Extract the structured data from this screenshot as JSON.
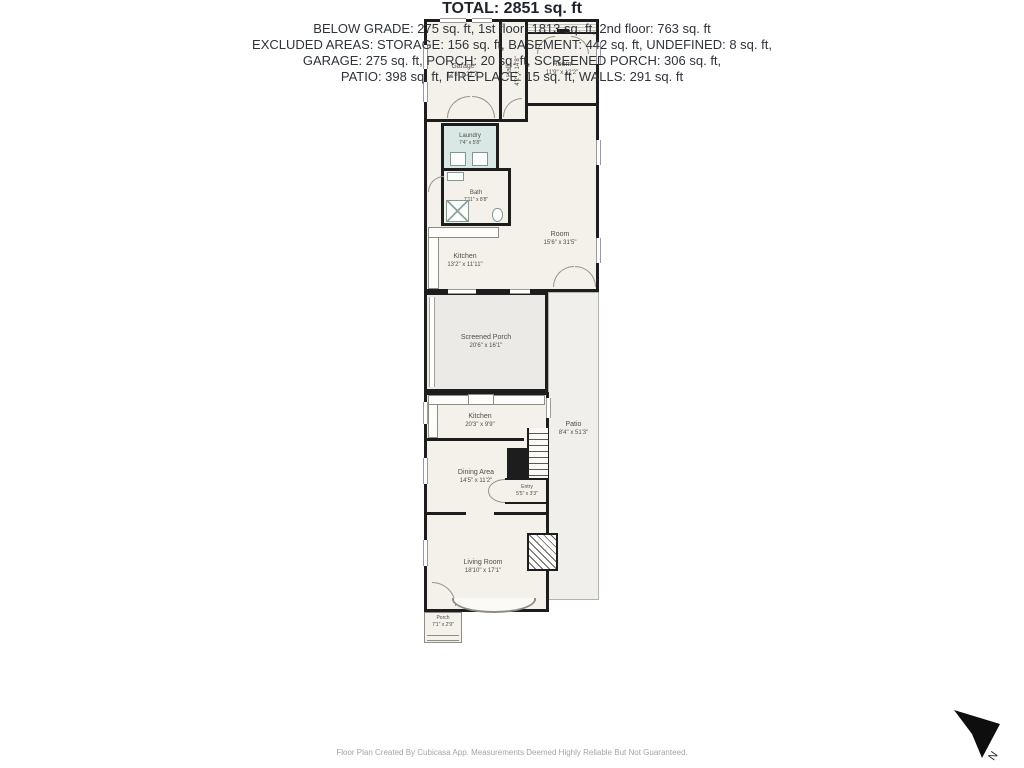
{
  "plan": {
    "rooms": {
      "garage": {
        "label": "Garage",
        "dims": "12'8\" x 27'7\""
      },
      "hall": {
        "label": "Hall",
        "dims": "4'2\" x 14'8\""
      },
      "top_room": {
        "label": "Room",
        "dims": "11'9\" x 12'2\""
      },
      "laundry": {
        "label": "Laundry",
        "dims": "7'4\" x 5'8\""
      },
      "bath": {
        "label": "Bath",
        "dims": "7'11\" x 8'8\""
      },
      "kitchen_upper": {
        "label": "Kitchen",
        "dims": "13'2\" x 11'11\""
      },
      "big_room": {
        "label": "Room",
        "dims": "15'6\" x 31'5\""
      },
      "screened_porch": {
        "label": "Screened Porch",
        "dims": "20'6\" x 16'1\""
      },
      "patio": {
        "label": "Patio",
        "dims": "8'4\" x 51'3\""
      },
      "kitchen_lower": {
        "label": "Kitchen",
        "dims": "20'3\" x 9'9\""
      },
      "dining": {
        "label": "Dining Area",
        "dims": "14'5\" x 11'2\""
      },
      "entry": {
        "label": "Entry",
        "dims": "5'5\" x 3'3\""
      },
      "living": {
        "label": "Living Room",
        "dims": "18'10\" x 17'1\""
      },
      "porch": {
        "label": "Porch",
        "dims": "7'1\" x 2'9\""
      }
    },
    "colors": {
      "wall": "#1d1d1d",
      "floor": "#f4f1ea",
      "laundry_fill": "#d9e8e4",
      "screened_porch_fill": "#eceae6",
      "patio_fill": "#f0efeb"
    }
  },
  "summary": {
    "total": "TOTAL: 2851 sq. ft",
    "lines": [
      "BELOW GRADE: 275 sq. ft, 1st floor: 1813 sq. ft, 2nd floor: 763 sq. ft",
      "EXCLUDED AREAS: STORAGE: 156 sq. ft, BASEMENT: 442 sq. ft, UNDEFINED: 8 sq. ft,",
      "GARAGE: 275 sq. ft, PORCH: 20 sq. ft, SCREENED PORCH: 306 sq. ft,",
      "PATIO: 398 sq. ft, FIREPLACE: 15 sq. ft, WALLS: 291 sq. ft"
    ]
  },
  "footer": {
    "disclaimer": "Floor Plan Created By Cubicasa App. Measurements Deemed Highly Reliable But Not Guaranteed."
  },
  "compass": {
    "label": "N"
  }
}
